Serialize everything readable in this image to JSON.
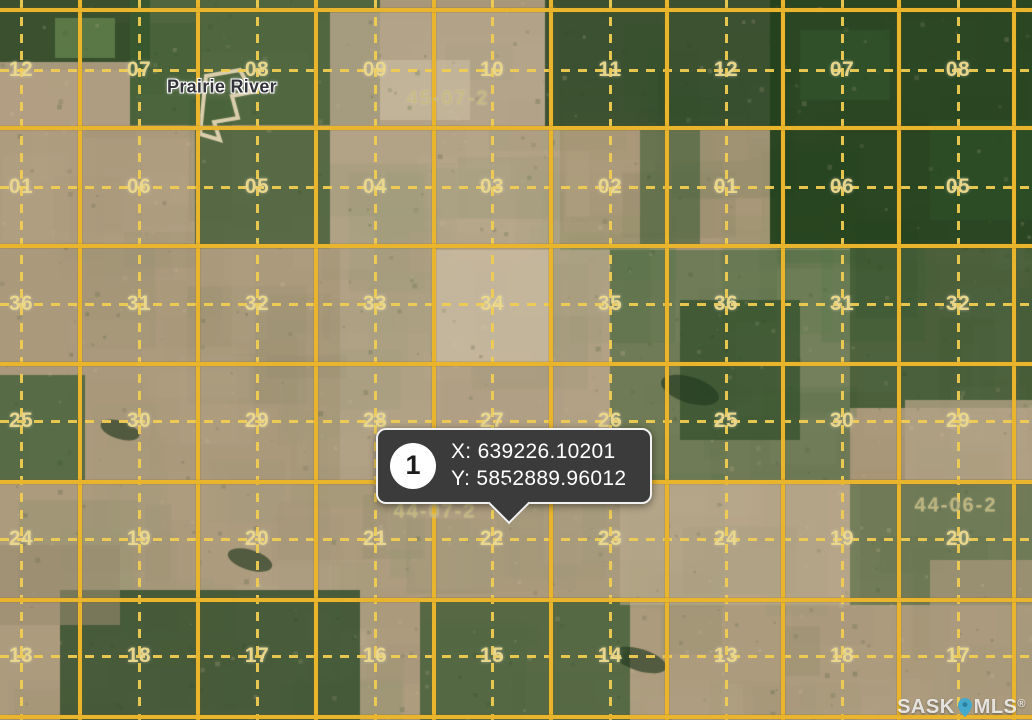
{
  "map": {
    "place_label": "Prairie River",
    "township_labels": [
      {
        "text": "45-07-2",
        "x": 448,
        "y": 99
      },
      {
        "text": "44-07-2",
        "x": 435,
        "y": 512
      },
      {
        "text": "44-06-2",
        "x": 956,
        "y": 506
      }
    ],
    "section_rows": [
      {
        "y": 70,
        "values": [
          "12",
          "07",
          "08",
          "09",
          "10",
          "11",
          "12",
          "07",
          "08"
        ]
      },
      {
        "y": 187,
        "values": [
          "01",
          "06",
          "05",
          "04",
          "03",
          "02",
          "01",
          "06",
          "05"
        ]
      },
      {
        "y": 304,
        "values": [
          "36",
          "31",
          "32",
          "33",
          "34",
          "35",
          "36",
          "31",
          "32"
        ]
      },
      {
        "y": 421,
        "values": [
          "25",
          "30",
          "29",
          "28",
          "27",
          "26",
          "25",
          "30",
          "29"
        ]
      },
      {
        "y": 539,
        "values": [
          "24",
          "19",
          "20",
          "21",
          "22",
          "23",
          "24",
          "19",
          "20"
        ]
      },
      {
        "y": 656,
        "values": [
          "13",
          "18",
          "17",
          "16",
          "15",
          "14",
          "13",
          "18",
          "17"
        ]
      }
    ],
    "grid": {
      "solid_color": "#e9b52d",
      "dashed_color": "#f0cc52",
      "solid_xs": [
        80,
        198,
        316,
        434,
        551,
        667,
        783,
        899,
        1014
      ],
      "solid_ys": [
        10,
        128,
        246,
        364,
        482,
        600,
        717
      ],
      "dashed_xs": [
        21,
        139,
        257,
        375,
        492,
        610,
        726,
        842,
        958
      ],
      "dashed_ys": [
        70,
        187,
        304,
        421,
        539,
        656
      ]
    },
    "label_colors": {
      "section": "rgba(236,218,142,0.95)",
      "township": "rgba(197,184,126,0.82)"
    },
    "terrain": {
      "base": "#a89778",
      "palette": [
        "#c3b396",
        "#a08f73",
        "#cfc1a4",
        "#94856c",
        "#b8a88c",
        "#87926d",
        "#5c7a4c",
        "#3f5d37",
        "#6b8a55",
        "#bda98b"
      ],
      "patches": [
        [
          0,
          0,
          150,
          70,
          "#2e4827",
          0.9
        ],
        [
          130,
          0,
          250,
          125,
          "#3a5a31",
          0.8
        ],
        [
          0,
          62,
          130,
          65,
          "#b2a084",
          0.9
        ],
        [
          55,
          18,
          60,
          40,
          "#7da05f",
          0.5
        ],
        [
          330,
          12,
          230,
          115,
          "#b4a58b",
          0.85
        ],
        [
          380,
          60,
          90,
          60,
          "#c5b89c",
          0.8
        ],
        [
          545,
          0,
          235,
          130,
          "#2c4827",
          0.88
        ],
        [
          770,
          0,
          262,
          248,
          "#24411e",
          0.95
        ],
        [
          800,
          30,
          90,
          70,
          "#31522a",
          0.8
        ],
        [
          930,
          120,
          102,
          100,
          "#2c4d25",
          0.8
        ],
        [
          0,
          128,
          330,
          120,
          "#b09d80",
          0.75
        ],
        [
          195,
          128,
          135,
          120,
          "#3b5a33",
          0.75
        ],
        [
          330,
          128,
          230,
          122,
          "#b7a78b",
          0.7
        ],
        [
          560,
          128,
          210,
          120,
          "#a89778",
          0.7
        ],
        [
          640,
          128,
          60,
          118,
          "#3f5e37",
          0.6
        ],
        [
          0,
          248,
          340,
          234,
          "#ab997c",
          0.75
        ],
        [
          0,
          375,
          85,
          107,
          "#42603a",
          0.8
        ],
        [
          340,
          250,
          270,
          232,
          "#b5a489",
          0.75
        ],
        [
          432,
          250,
          118,
          112,
          "#c8baa0",
          0.85
        ],
        [
          610,
          250,
          240,
          230,
          "#49673f",
          0.6
        ],
        [
          680,
          300,
          120,
          140,
          "#2f4d28",
          0.7
        ],
        [
          850,
          248,
          182,
          160,
          "#33512c",
          0.8
        ],
        [
          905,
          400,
          127,
          85,
          "#b2a184",
          0.8
        ],
        [
          0,
          482,
          1032,
          238,
          "#ae9c7f",
          0.65
        ],
        [
          60,
          590,
          300,
          130,
          "#2e4b29",
          0.8
        ],
        [
          0,
          545,
          120,
          80,
          "#9a8a6f",
          0.6
        ],
        [
          420,
          598,
          210,
          122,
          "#3a5832",
          0.75
        ],
        [
          620,
          480,
          240,
          125,
          "#bcab8f",
          0.6
        ],
        [
          850,
          480,
          182,
          125,
          "#4a663e",
          0.6
        ],
        [
          930,
          560,
          102,
          160,
          "#ab9a7d",
          0.7
        ]
      ]
    }
  },
  "marker_tooltip": {
    "number": "1",
    "x_text": "X: 639226.10201",
    "y_text": "Y: 5852889.96012"
  },
  "watermark": {
    "prefix": "SASK",
    "suffix": "MLS",
    "registered": "®",
    "pin_color": "#45a9cb"
  }
}
